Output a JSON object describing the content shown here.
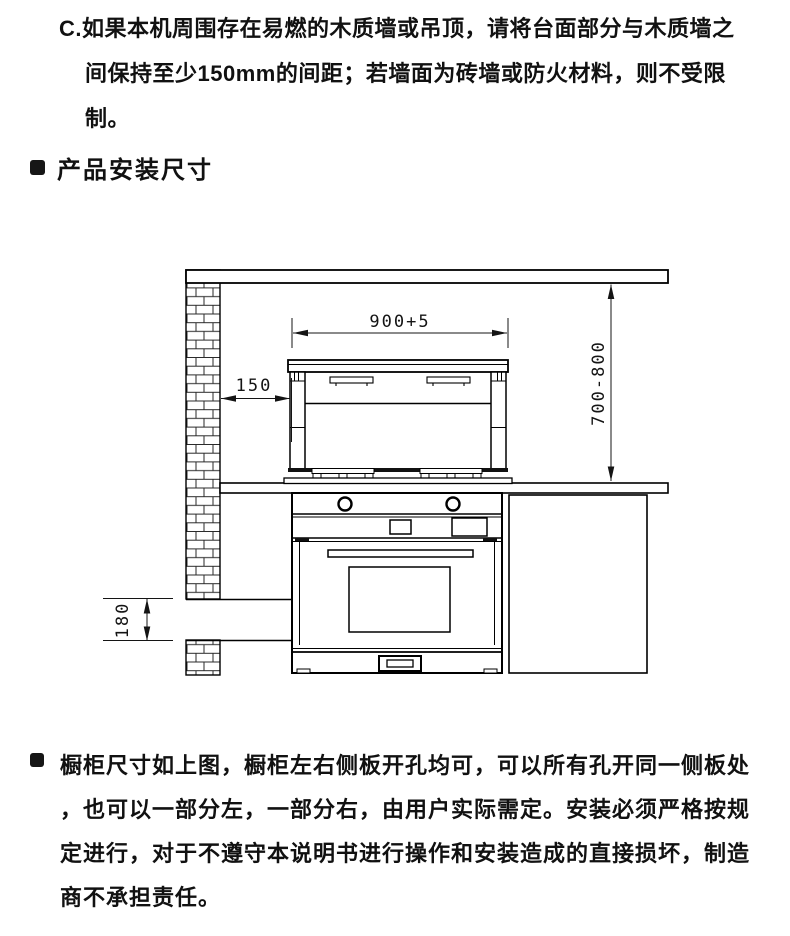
{
  "document": {
    "background": "#ffffff",
    "text_color": "#111111",
    "line_color": "#000000"
  },
  "top_note": {
    "lines": [
      "C.如果本机周围存在易燃的木质墙或吊顶，请将台面部分与木质墙之",
      "间保持至少150mm的间距；若墙面为砖墙或防火材料，则不受限",
      "制。"
    ]
  },
  "section_header": {
    "title": "产品安装尺寸"
  },
  "installation_diagram": {
    "dimensions": {
      "hood_width": "900+5",
      "wall_clearance": "150",
      "height_range": "700-800",
      "plinth_height": "180"
    }
  },
  "cabinet_note": {
    "lines": [
      "橱柜尺寸如上图，橱柜左右侧板开孔均可，可以所有孔开同一侧板处",
      "，也可以一部分左，一部分右，由用户实际需定。安装必须严格按规",
      "定进行，对于不遵守本说明书进行操作和安装造成的直接损坏，制造",
      "商不承担责任。"
    ]
  }
}
